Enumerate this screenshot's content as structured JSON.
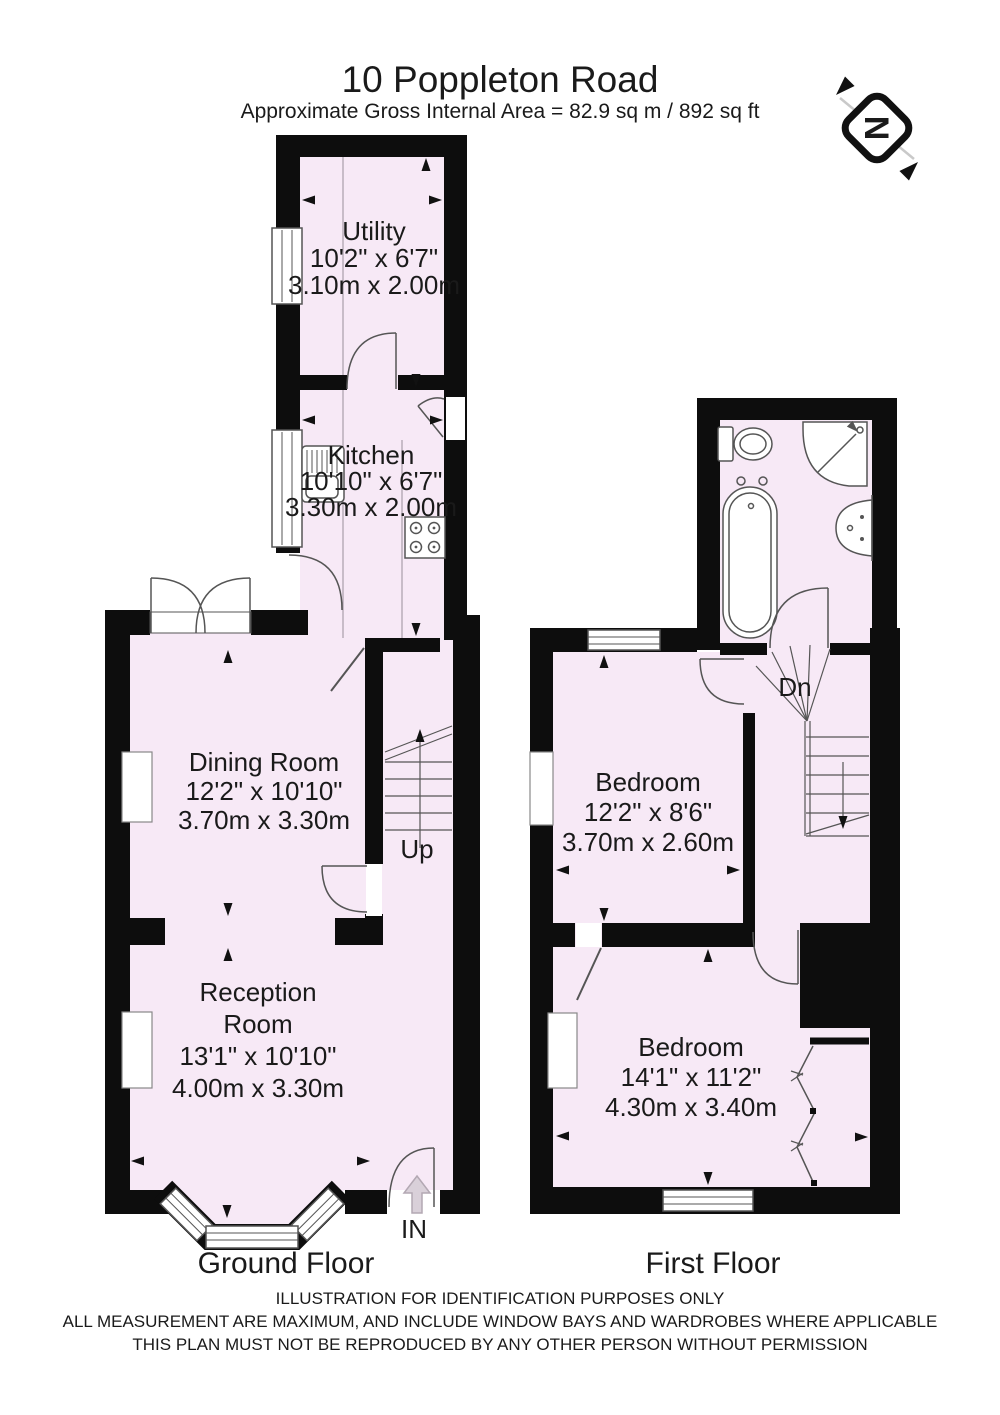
{
  "title": "10 Poppleton Road",
  "subtitle": "Approximate Gross Internal Area = 82.9 sq m / 892 sq ft",
  "compass_letter": "N",
  "ground_floor": {
    "label": "Ground Floor",
    "utility": {
      "name": "Utility",
      "imperial": "10'2\" x 6'7\"",
      "metric": "3.10m x 2.00m"
    },
    "kitchen": {
      "name": "Kitchen",
      "imperial": "10'10\" x 6'7\"",
      "metric": "3.30m x 2.00m"
    },
    "dining": {
      "name": "Dining Room",
      "imperial": "12'2\" x 10'10\"",
      "metric": "3.70m x 3.30m"
    },
    "reception": {
      "line1": "Reception",
      "line2": "Room",
      "imperial": "13'1\" x 10'10\"",
      "metric": "4.00m x 3.30m"
    },
    "up": "Up",
    "in": "IN"
  },
  "first_floor": {
    "label": "First Floor",
    "bedroom1": {
      "name": "Bedroom",
      "imperial": "12'2\" x 8'6\"",
      "metric": "3.70m x 2.60m"
    },
    "bedroom2": {
      "name": "Bedroom",
      "imperial": "14'1\" x 11'2\"",
      "metric": "4.30m x 3.40m"
    },
    "dn": "Dn"
  },
  "footer": {
    "line1": "ILLUSTRATION FOR IDENTIFICATION PURPOSES ONLY",
    "line2": "ALL MEASUREMENT  ARE MAXIMUM, AND INCLUDE WINDOW BAYS AND WARDROBES WHERE APPLICABLE",
    "line3": "THIS PLAN MUST NOT BE REPRODUCED BY ANY OTHER PERSON WITHOUT PERMISSION"
  },
  "colors": {
    "room_fill": "#f7e9f6",
    "wall": "#0d0d0d",
    "line": "#555555"
  }
}
